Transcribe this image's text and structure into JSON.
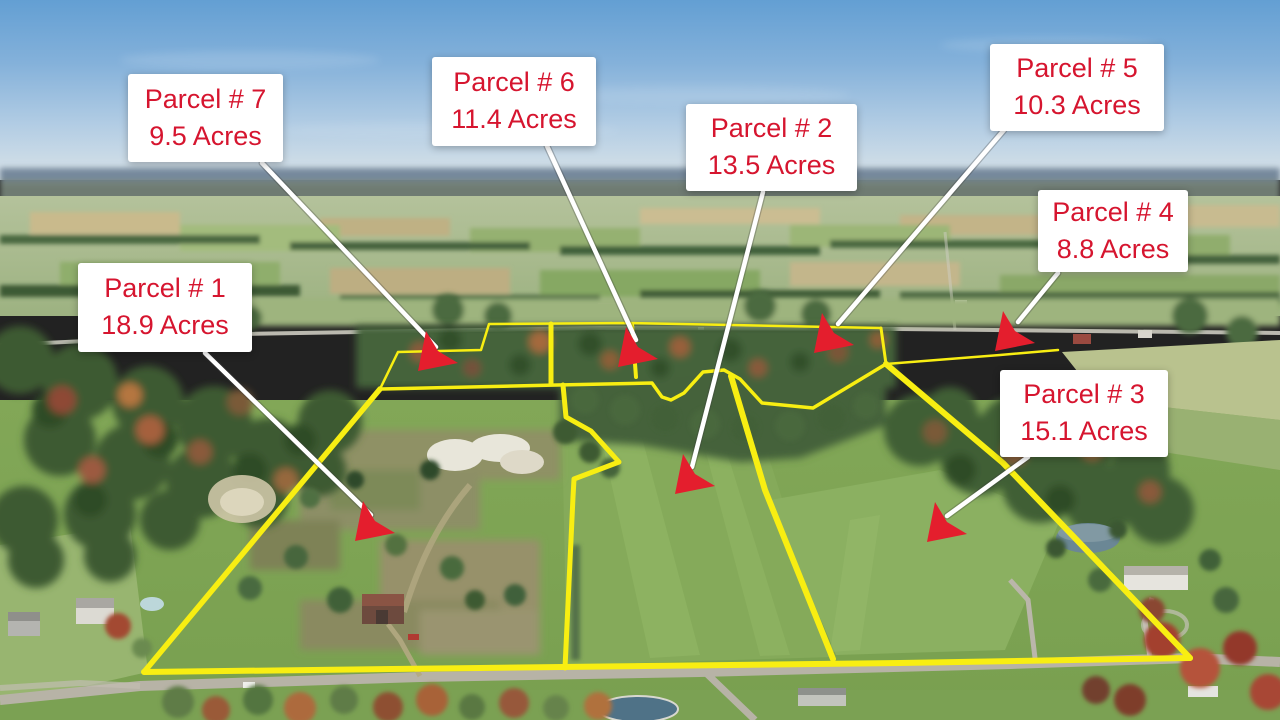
{
  "image_type": "annotated aerial drone photograph of farmland for sale",
  "caption": "Seven land parcels outlined in yellow with acreage callouts",
  "colors": {
    "label_bg": "#ffffff",
    "label_text": "#d6152f",
    "arrow_line": "#ffffff",
    "arrow_head": "#e41e2d",
    "boundary": "#f8ee12"
  },
  "parcels": [
    {
      "name": "Parcel # 1",
      "acres": "18.9 Acres"
    },
    {
      "name": "Parcel # 2",
      "acres": "13.5 Acres"
    },
    {
      "name": "Parcel # 3",
      "acres": "15.1 Acres"
    },
    {
      "name": "Parcel # 4",
      "acres": "8.8 Acres"
    },
    {
      "name": "Parcel # 5",
      "acres": "10.3 Acres"
    },
    {
      "name": "Parcel # 6",
      "acres": "11.4 Acres"
    },
    {
      "name": "Parcel # 7",
      "acres": "9.5 Acres"
    }
  ]
}
